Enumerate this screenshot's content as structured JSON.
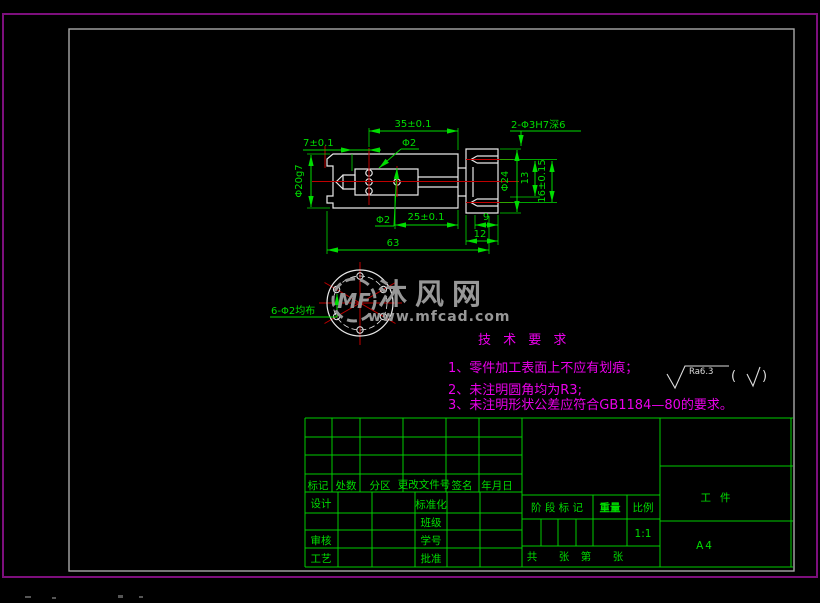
{
  "colors": {
    "cad_green": "#00dd00",
    "centerline_red": "#c00000",
    "outline_white": "#e8e8e8",
    "note_magenta": "#ea00ea",
    "border_magenta": "#7d0f7d",
    "frame_gray": "#a8a8a8",
    "watermark_gray": "#979797"
  },
  "drawing": {
    "dimensions": {
      "len35": "35±0.1",
      "len7": "7±0.1",
      "dia2_top": "Φ2",
      "dia2_bot": "Φ2",
      "len25": "25±0.1",
      "len9": "9",
      "len12": "12",
      "len63": "63",
      "dia20": "Φ20g7",
      "dia24": "Φ24",
      "len13": "13",
      "len16": "16±0.15",
      "holes_flange": "2-Φ3H7深6",
      "holes_radial": "6-Φ2均布"
    },
    "tech_req": {
      "title": "技 术 要 求",
      "item1": "1、零件加工表面上不应有划痕；",
      "item2": "2、未注明圆角均为R3;",
      "item3": "3、未注明形状公差应符合GB1184—80的要求。"
    },
    "roughness": {
      "value": "Ra6.3",
      "paren_open": "(",
      "paren_close": ")"
    }
  },
  "watermark": {
    "logo": "MF",
    "site_name": "沐风网",
    "site_url": "www.mfcad.com"
  },
  "title_block": {
    "revision_header": {
      "mark": "标记",
      "count": "处数",
      "zone": "分区",
      "doc_no": "更改文件号",
      "sign": "签名",
      "date": "年月日"
    },
    "roles": {
      "design": "设计",
      "standard": "标准化",
      "class": "班级",
      "check": "审核",
      "student_no": "学号",
      "process": "工艺",
      "approve": "批准"
    },
    "stage": {
      "label": "阶 段 标 记",
      "weight": "重量",
      "scale": "比例",
      "scale_value": "1:1"
    },
    "sheets": {
      "total": "共",
      "sheet_a": "张",
      "no": "第",
      "sheet_b": "张"
    },
    "part_name": "工件",
    "paper_size": "A4"
  }
}
